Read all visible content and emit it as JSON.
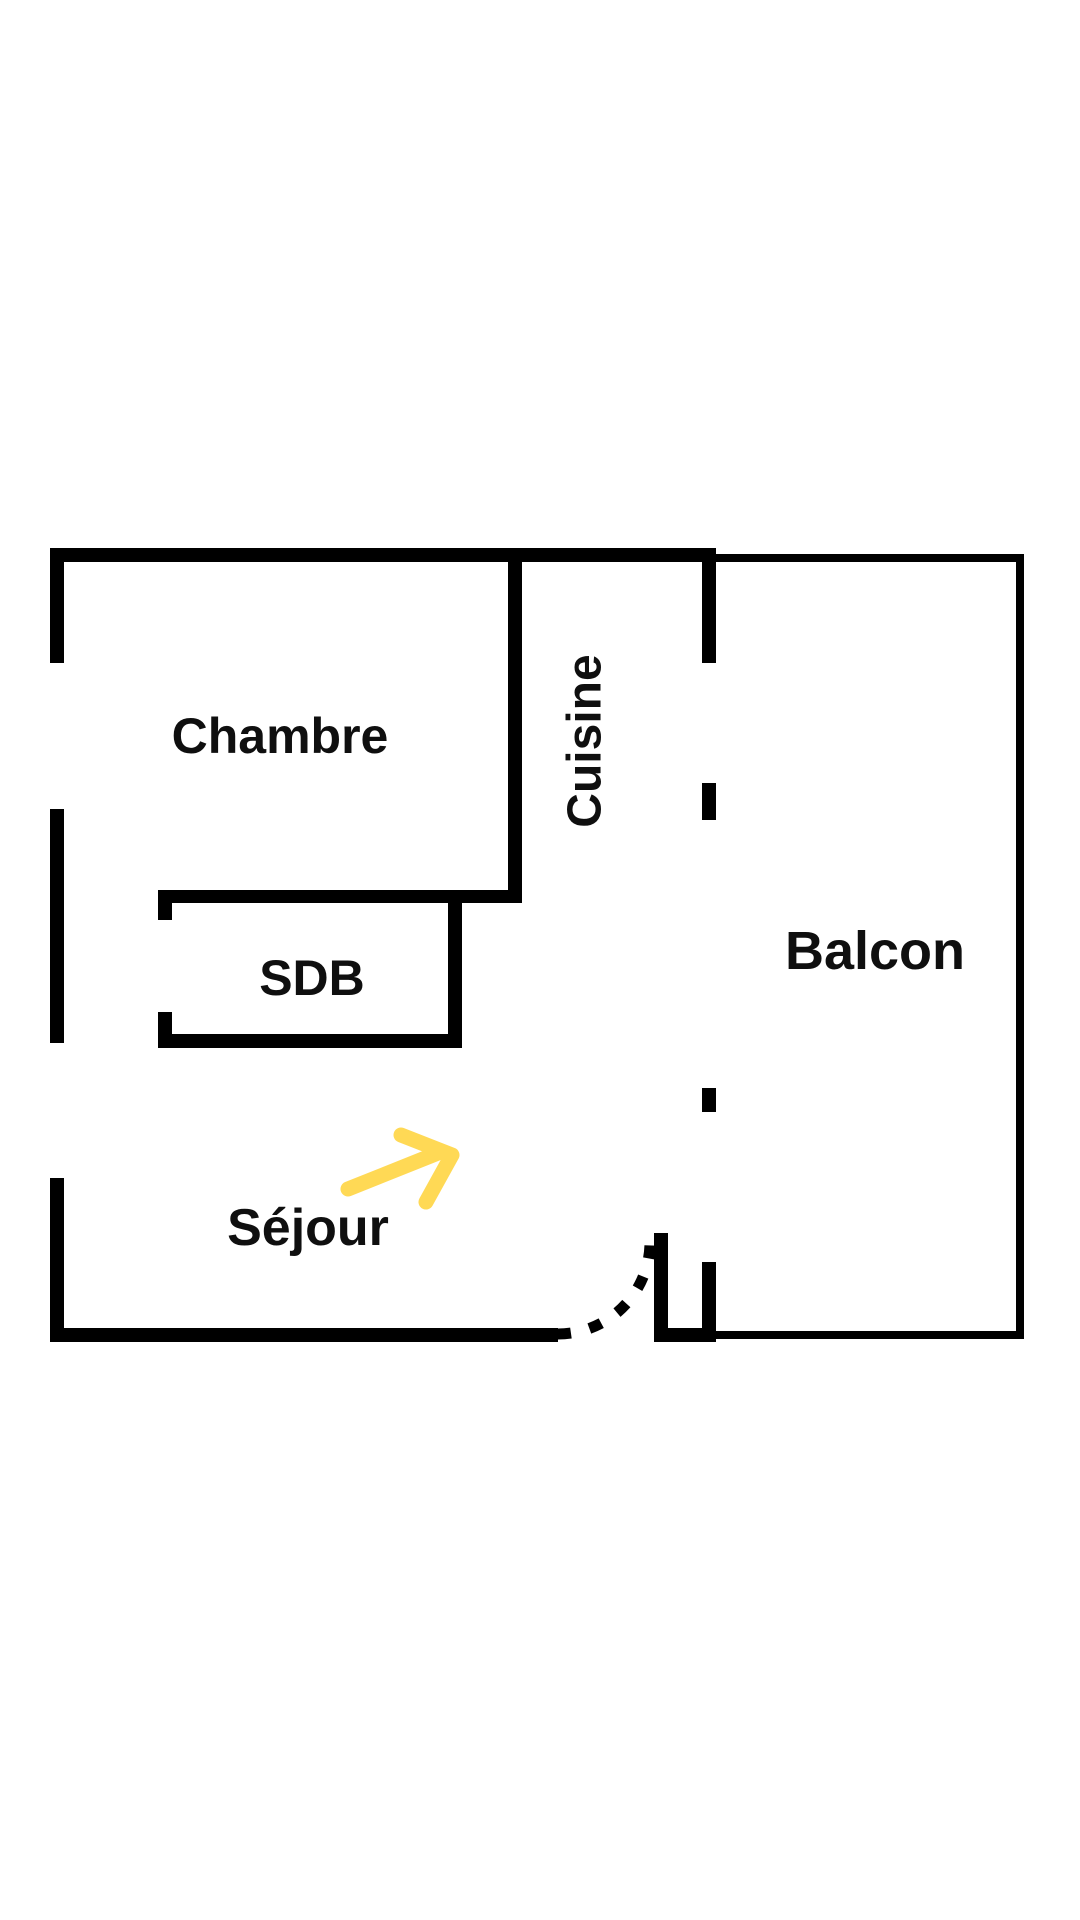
{
  "colors": {
    "background": "#FFFFFF",
    "wall": "#000000",
    "label": "#0F0F0F",
    "arrow": "#FFD955"
  },
  "plan": {
    "type": "apartment-floor-plan",
    "rooms": {
      "chambre": {
        "label": "Chambre"
      },
      "cuisine": {
        "label": "Cuisine"
      },
      "sdb": {
        "label": "SDB"
      },
      "balcon": {
        "label": "Balcon"
      },
      "sejour": {
        "label": "Séjour"
      }
    },
    "annotations": {
      "entrance_door": {
        "style": "dashed quarter-circle swing arc"
      },
      "direction_arrow": {
        "style": "hand-drawn arrow pointing up-right",
        "color": "#FFD955"
      }
    }
  }
}
